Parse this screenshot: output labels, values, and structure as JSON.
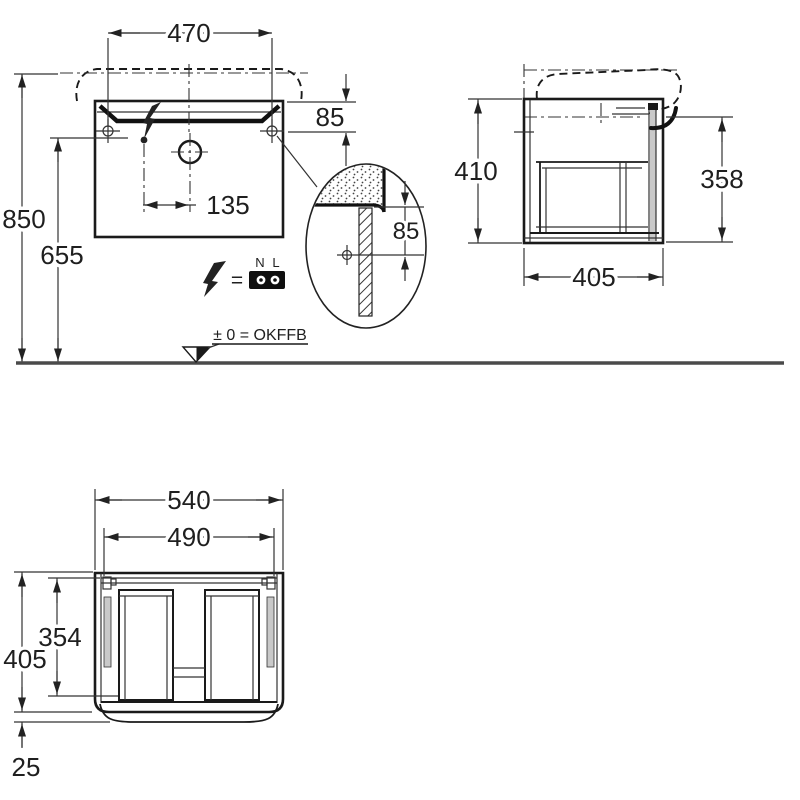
{
  "page": {
    "title": "Washbasin vanity unit installation drawing",
    "colors": {
      "line": "#1a1a1a",
      "dimension": "#333333",
      "ground": "#4a4a4a",
      "panel_gray": "#c9c9c9",
      "terminal_block": "#0f0f0f"
    }
  },
  "views": {
    "front": {
      "dims": {
        "fixing_width": "470",
        "top_to_fixing": "85",
        "floor_to_rim": "850",
        "floor_to_fixing": "655",
        "outlet_offset": "135"
      }
    },
    "side": {
      "dims": {
        "body_height": "410",
        "recess_to_bottom": "358",
        "body_depth": "405"
      }
    },
    "detail": {
      "dims": {
        "top_to_fixing": "85"
      }
    },
    "plan": {
      "dims": {
        "body_width": "540",
        "inner_width": "490",
        "inner_depth": "354",
        "body_depth": "405",
        "door_offset": "25"
      }
    }
  },
  "electrical_legend": {
    "equals_sign": "=",
    "terminal_left": "N",
    "terminal_right": "L"
  },
  "level_marker": {
    "label": "± 0 = OKFFB"
  }
}
